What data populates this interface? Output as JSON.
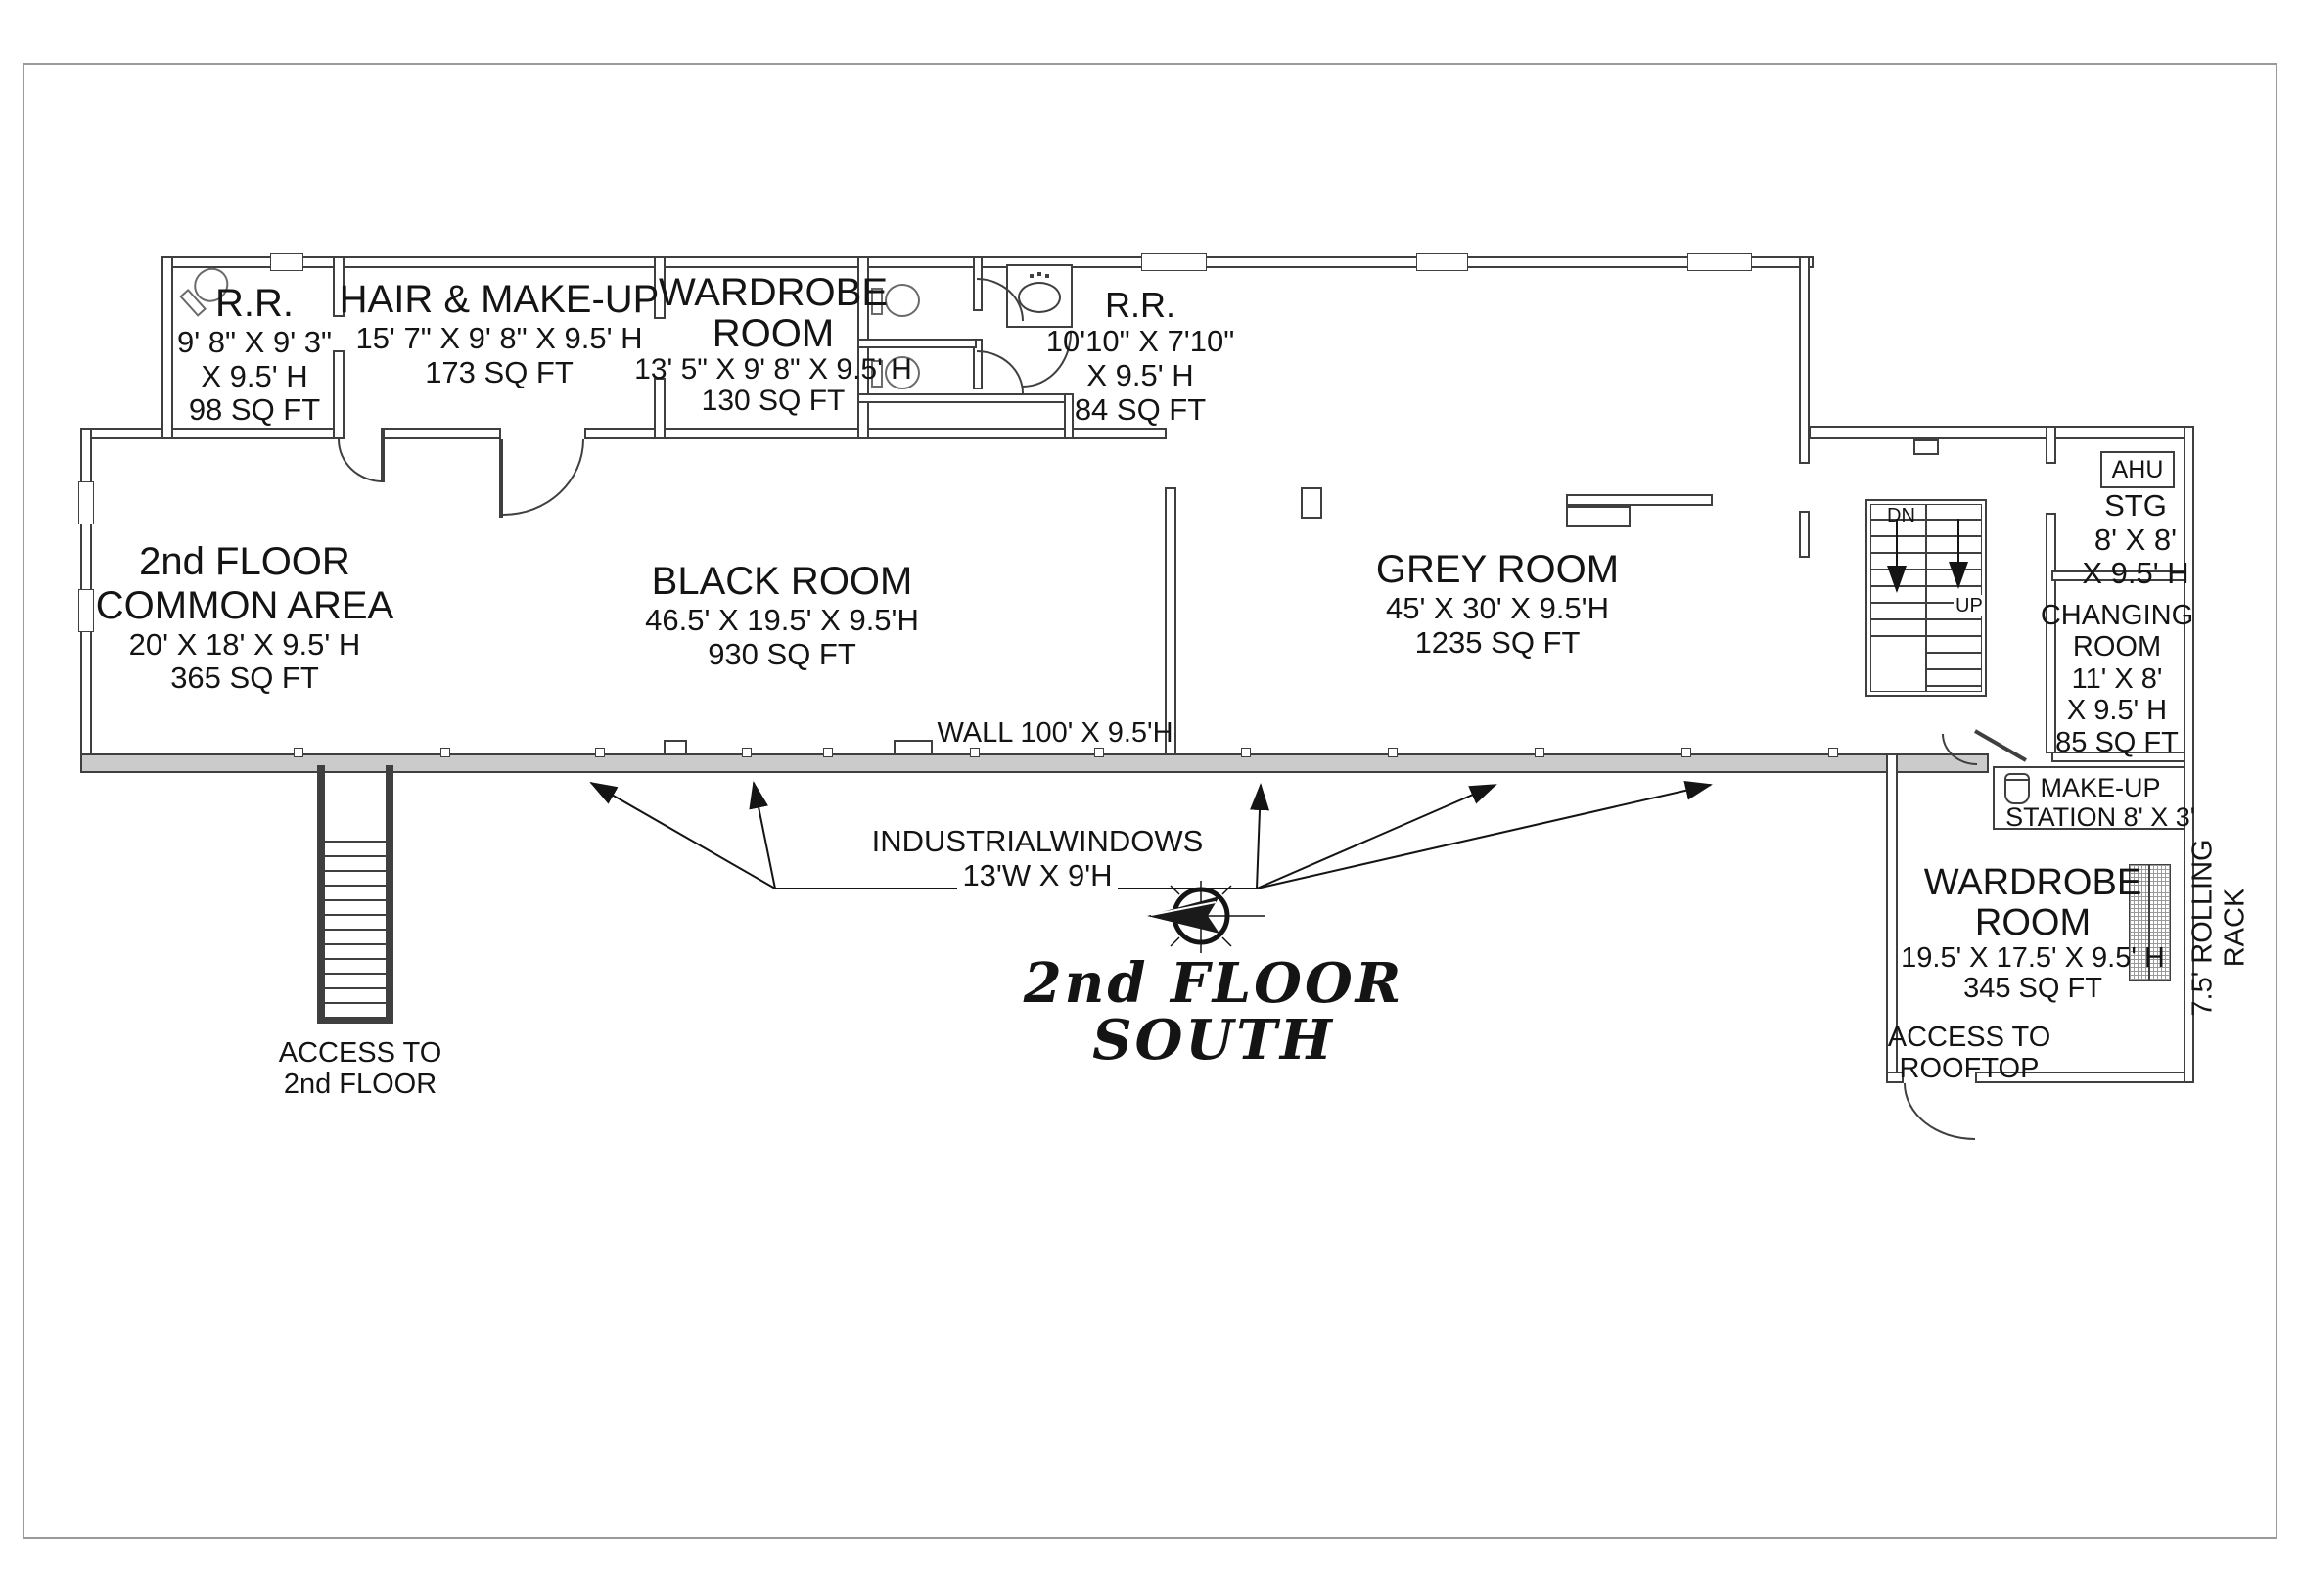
{
  "title": {
    "t1": "2nd FLOOR",
    "t2": "SOUTH"
  },
  "rooms": {
    "rr_top": {
      "name": "R.R.",
      "l1": "9' 8\" X 9' 3\"",
      "l2": "X 9.5' H",
      "l3": "98 SQ FT"
    },
    "hair": {
      "name": "HAIR & MAKE-UP",
      "l1": "15' 7\" X 9' 8\" X 9.5' H",
      "l2": "173 SQ FT"
    },
    "wardrobe_top": {
      "n1": "WARDROBE",
      "n2": "ROOM",
      "l1": "13' 5\" X 9' 8\" X 9.5' H",
      "l2": "130 SQ FT"
    },
    "rr_mid": {
      "name": "R.R.",
      "l1": "10'10\" X 7'10\"",
      "l2": "X 9.5' H",
      "l3": "84 SQ FT"
    },
    "common": {
      "n1": "2nd FLOOR",
      "n2": "COMMON AREA",
      "l1": "20' X 18' X 9.5' H",
      "l2": "365 SQ FT"
    },
    "black": {
      "name": "BLACK ROOM",
      "l1": "46.5' X 19.5' X 9.5'H",
      "l2": "930 SQ FT"
    },
    "grey": {
      "name": "GREY ROOM",
      "l1": "45' X 30' X 9.5'H",
      "l2": "1235 SQ FT"
    },
    "ahu": {
      "name": "AHU"
    },
    "stg": {
      "name": "STG",
      "l1": "8' X 8'",
      "l2": "X 9.5' H"
    },
    "changing": {
      "n1": "CHANGING",
      "n2": "ROOM",
      "l1": "11' X 8'",
      "l2": "X 9.5' H",
      "l3": "85 SQ FT"
    },
    "makeup": {
      "l1": "MAKE-UP",
      "l2": "STATION 8' X 3'"
    },
    "wardrobe_br": {
      "n1": "WARDROBE",
      "n2": "ROOM",
      "l1": "19.5' X 17.5' X 9.5' H",
      "l2": "345 SQ FT"
    }
  },
  "annotations": {
    "wall_label": "WALL 100' X 9.5'H",
    "win1": "INDUSTRIALWINDOWS",
    "win2": "13'W X 9'H",
    "acc2_1": "ACCESS TO",
    "acc2_2": "2nd FLOOR",
    "accr_1": "ACCESS TO",
    "accr_2": "ROOFTOP",
    "rack1": "7.5' ROLLING",
    "rack2": "RACK",
    "dn": "DN",
    "up": "UP"
  },
  "colors": {
    "wall": "#3f3f3f",
    "window_band": "#cbcbcb",
    "text": "#141414",
    "frame": "#9a9a9a"
  }
}
